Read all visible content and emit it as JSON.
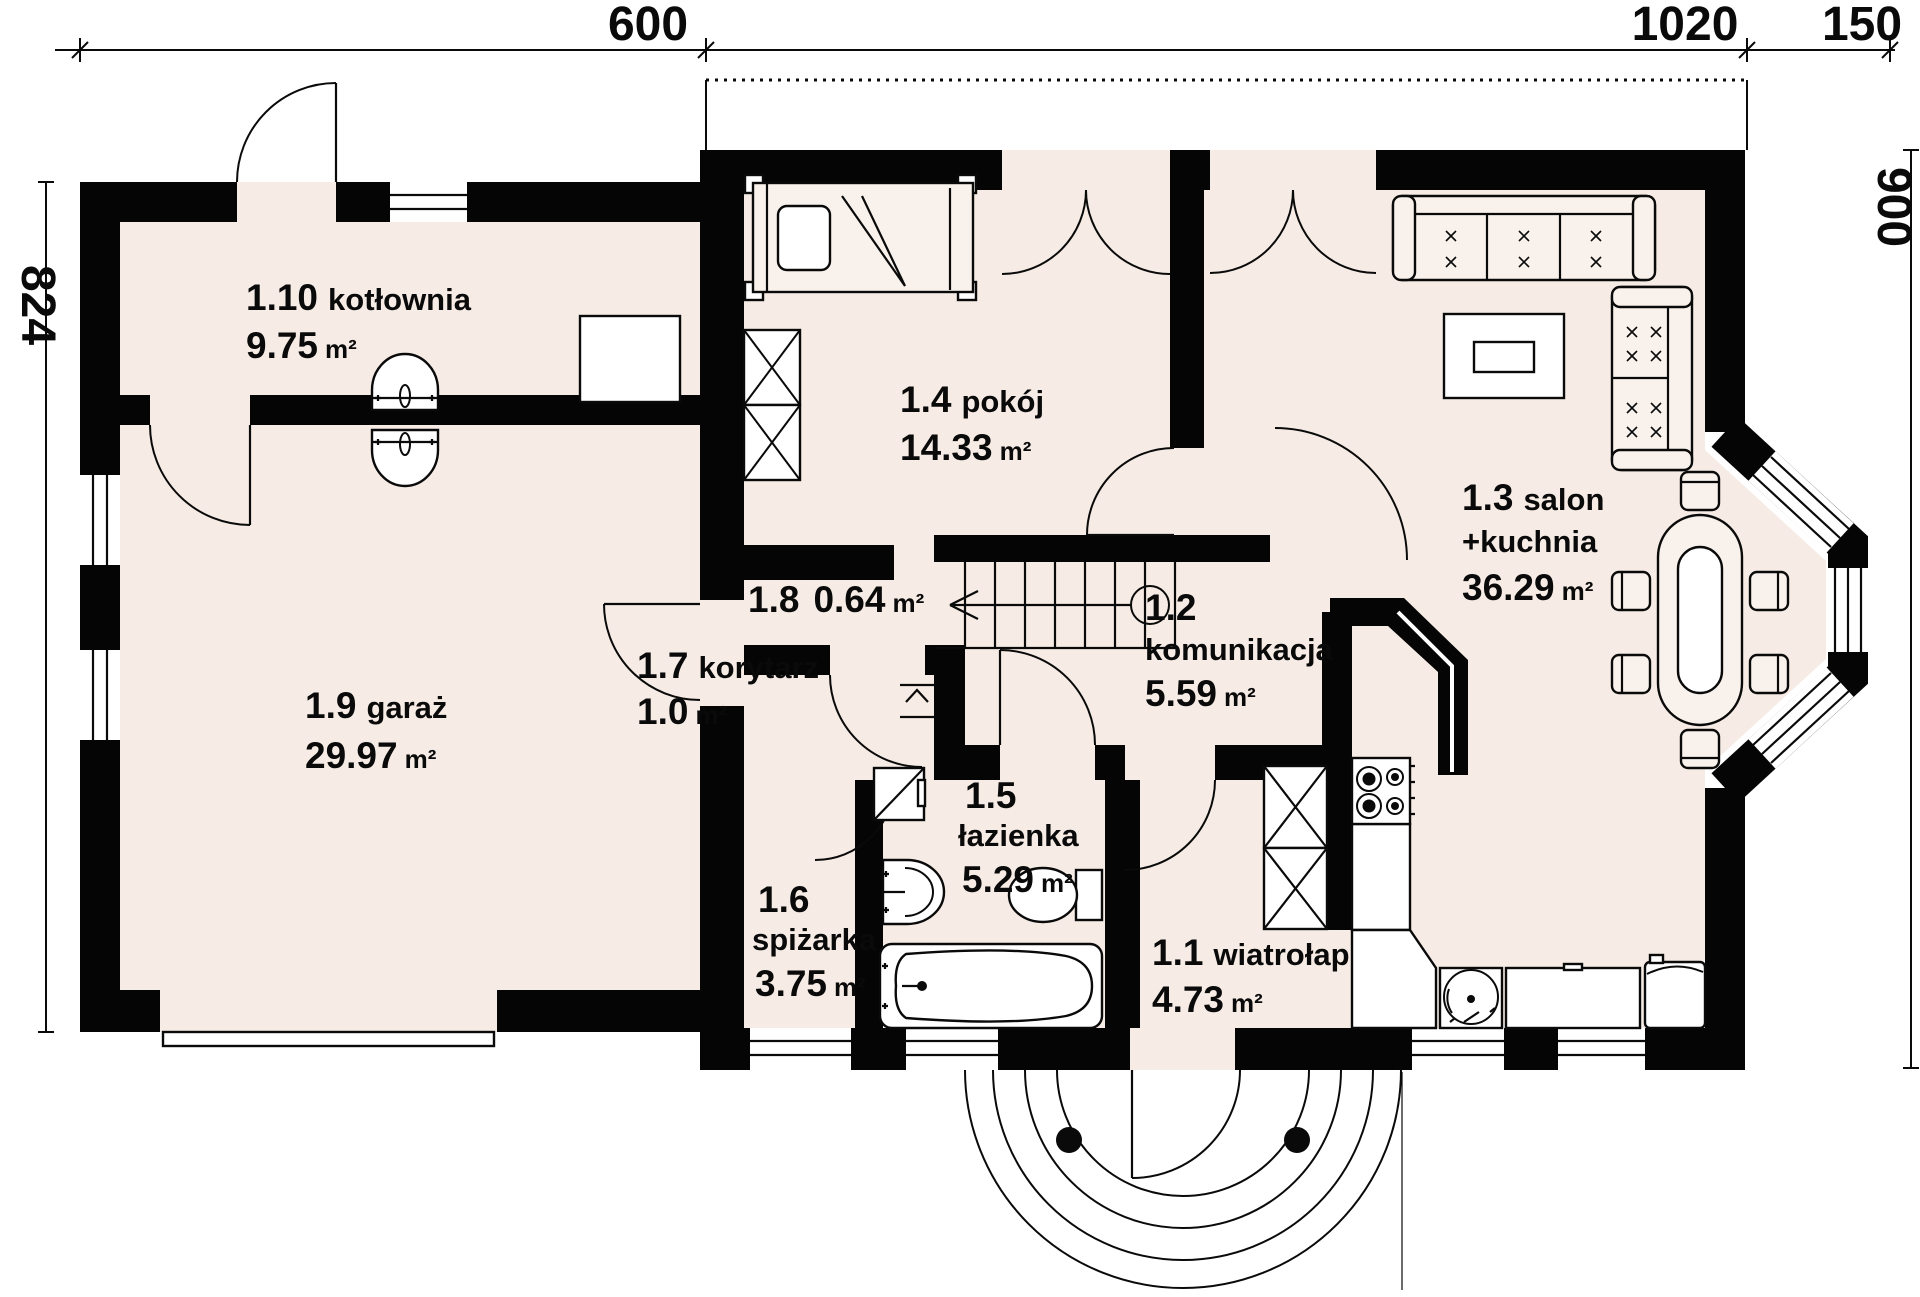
{
  "plan": {
    "type": "architectural-floor-plan",
    "level": "ground floor",
    "dimensions": {
      "top": [
        "600",
        "1020",
        "150"
      ],
      "left": "824",
      "right": "900"
    },
    "rooms": [
      {
        "num": "1.1",
        "name": "wiatrołap",
        "area": "4.73",
        "unit": "m²"
      },
      {
        "num": "1.2",
        "name": "komunikacja",
        "area": "5.59",
        "unit": "m²"
      },
      {
        "num": "1.3",
        "name": "salon",
        "name2": "+kuchnia",
        "area": "36.29",
        "unit": "m²"
      },
      {
        "num": "1.4",
        "name": "pokój",
        "area": "14.33",
        "unit": "m²"
      },
      {
        "num": "1.5",
        "name": "łazienka",
        "area": "5.29",
        "unit": "m²"
      },
      {
        "num": "1.6",
        "name": "spiżarka",
        "area": "3.75",
        "unit": "m²"
      },
      {
        "num": "1.7",
        "name": "korytarz",
        "area": "1.0",
        "unit": "m²"
      },
      {
        "num": "1.8",
        "name": "",
        "area": "0.64",
        "unit": "m²"
      },
      {
        "num": "1.9",
        "name": "garaż",
        "area": "29.97",
        "unit": "m²"
      },
      {
        "num": "1.10",
        "name": "kotłownia",
        "area": "9.75",
        "unit": "m²"
      }
    ],
    "colors": {
      "wall": "#050505",
      "floor": "#f6ece5",
      "background": "#ffffff"
    }
  }
}
